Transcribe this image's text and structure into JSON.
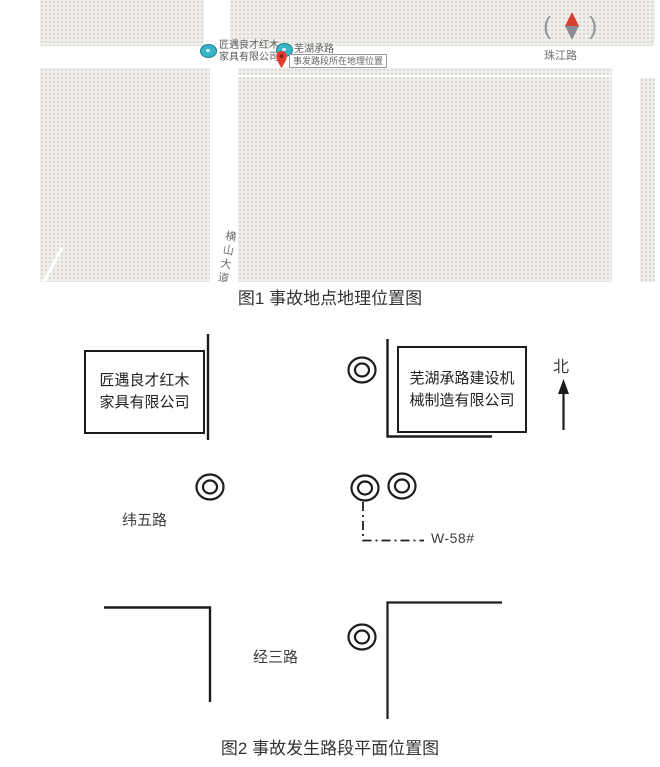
{
  "figure1": {
    "caption": "图1 事故地点地理位置图",
    "map": {
      "company1_label_line1": "匠遇良才红木",
      "company1_label_line2": "家具有限公司",
      "company2_label": "芜湖承路",
      "pin_label": "事发路段所在地理位置",
      "road_east": "珠江路",
      "road_south": "横山大道",
      "compass_left_glyph": "(",
      "compass_right_glyph": ")"
    }
  },
  "figure2": {
    "caption": "图2 事故发生路段平面位置图",
    "left_company_line1": "匠遇良才红木",
    "left_company_line2": "家具有限公司",
    "right_company_line1": "芜湖承路建设机",
    "right_company_line2": "械制造有限公司",
    "north_label": "北",
    "pole_id": "W-58#",
    "road_weiwu": "纬五路",
    "road_jingsan": "经三路"
  },
  "colors": {
    "marker_teal": "#38b6c9",
    "pin_red": "#e23c2e",
    "compass_red": "#d43f2f",
    "diagram_line": "#1c1c1c",
    "map_block_gray": "#f1efec"
  }
}
